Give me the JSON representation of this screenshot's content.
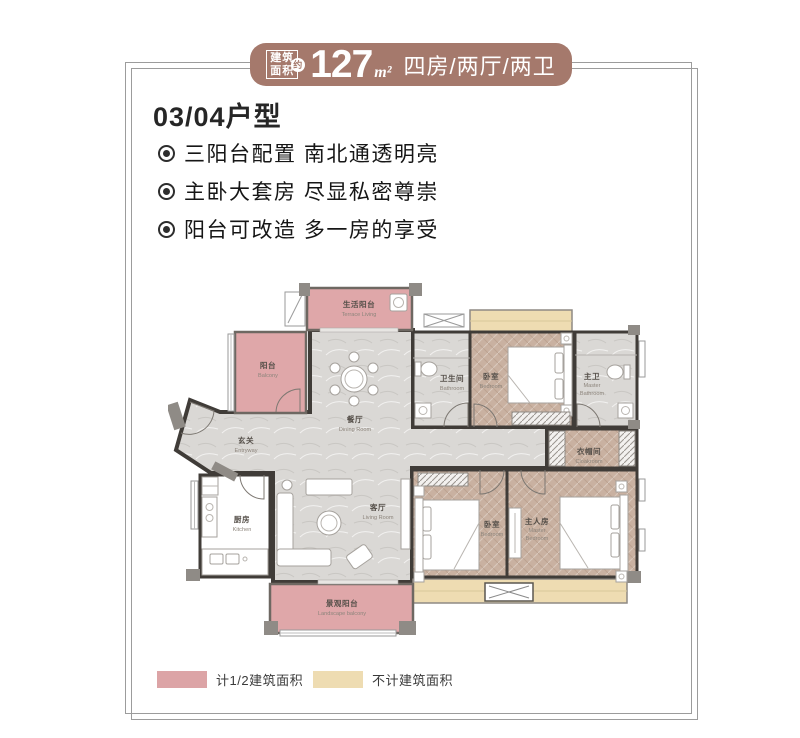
{
  "badge": {
    "prefix_line1": "建筑",
    "prefix_line2": "面积",
    "approx": "约",
    "value": "127",
    "unit": "m²",
    "spec": "四房/两厅/两卫"
  },
  "title": "03/04户型",
  "features": [
    "三阳台配置 南北通透明亮",
    "主卧大套房 尽显私密尊崇",
    "阳台可改造 多一房的享受"
  ],
  "floorplan": {
    "rooms": [
      {
        "id": "terrace-living",
        "cn": "生活阳台",
        "en": "Terrace Living"
      },
      {
        "id": "balcony",
        "cn": "阳台",
        "en": "Balcony"
      },
      {
        "id": "dining",
        "cn": "餐厅",
        "en": "Dining Room"
      },
      {
        "id": "entry",
        "cn": "玄关",
        "en": "Entryway"
      },
      {
        "id": "kitchen",
        "cn": "厨房",
        "en": "Kitchen"
      },
      {
        "id": "living",
        "cn": "客厅",
        "en": "Living Room"
      },
      {
        "id": "landscape",
        "cn": "景观阳台",
        "en": "Landscape balcony"
      },
      {
        "id": "bathroom",
        "cn": "卫生间",
        "en": "Bathroom"
      },
      {
        "id": "bedroom-north",
        "cn": "卧室",
        "en": "Bedroom"
      },
      {
        "id": "master-bath",
        "cn": "主卫",
        "en1": "Master",
        "en2": "Bathroom"
      },
      {
        "id": "cloakroom",
        "cn": "衣帽间",
        "en": "Cloakroom"
      },
      {
        "id": "bedroom-south",
        "cn": "卧室",
        "en": "Bedroom"
      },
      {
        "id": "master-bedroom",
        "cn": "主人房",
        "en1": "Master",
        "en2": "Bedroom"
      }
    ]
  },
  "legend": {
    "items": [
      {
        "label": "计1/2建筑面积",
        "color": "#dca4a6"
      },
      {
        "label": "不计建筑面积",
        "color": "#eedcb2"
      }
    ]
  },
  "colors": {
    "badge_bg": "#a5796c",
    "half_area_pink": "#dfa7a9",
    "excluded_beige": "#eedcb2",
    "wall": "#403c38"
  }
}
